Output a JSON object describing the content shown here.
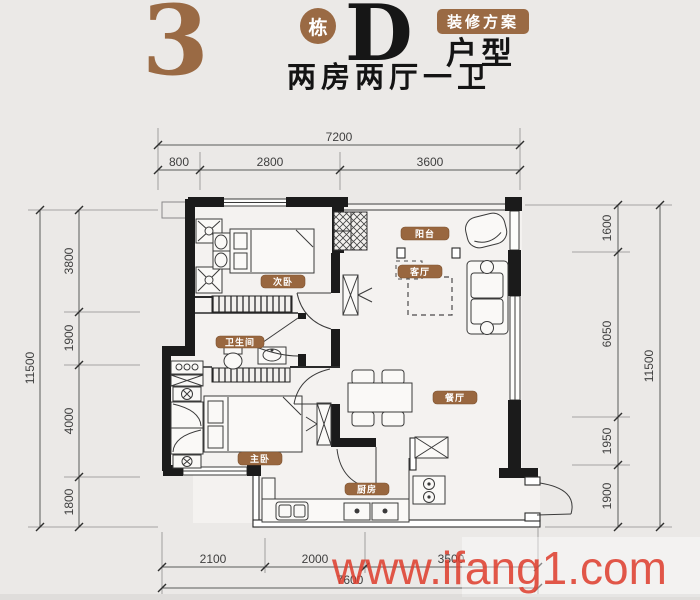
{
  "header": {
    "building_number": "3",
    "building_unit": "栋",
    "plan_letter": "D",
    "decor_badge": "装修方案",
    "type_label": "户型",
    "subtitle": "两房两厅一卫"
  },
  "rooms": {
    "balcony": "阳台",
    "living": "客厅",
    "bedroom2": "次卧",
    "bathroom": "卫生间",
    "master": "主卧",
    "dining": "餐厅",
    "kitchen": "厨房"
  },
  "dimensions": {
    "top": {
      "total": "7200",
      "segments": [
        "800",
        "2800",
        "3600"
      ]
    },
    "left": {
      "total": "11500",
      "segments": [
        "3800",
        "1900",
        "4000",
        "1800"
      ]
    },
    "right": {
      "total": "11500",
      "segments": [
        "1600",
        "6050",
        "1950",
        "1900"
      ]
    },
    "bottom": {
      "total": "7600",
      "segments": [
        "2100",
        "2000",
        "3500"
      ]
    }
  },
  "watermark": "www.ifang1.com",
  "colors": {
    "accent_brown": "#9a6a44",
    "label_brown": "#99673f",
    "wall_black": "#1b1b1b",
    "watermark_red": "#de4030",
    "background": "#ebe9e7"
  }
}
